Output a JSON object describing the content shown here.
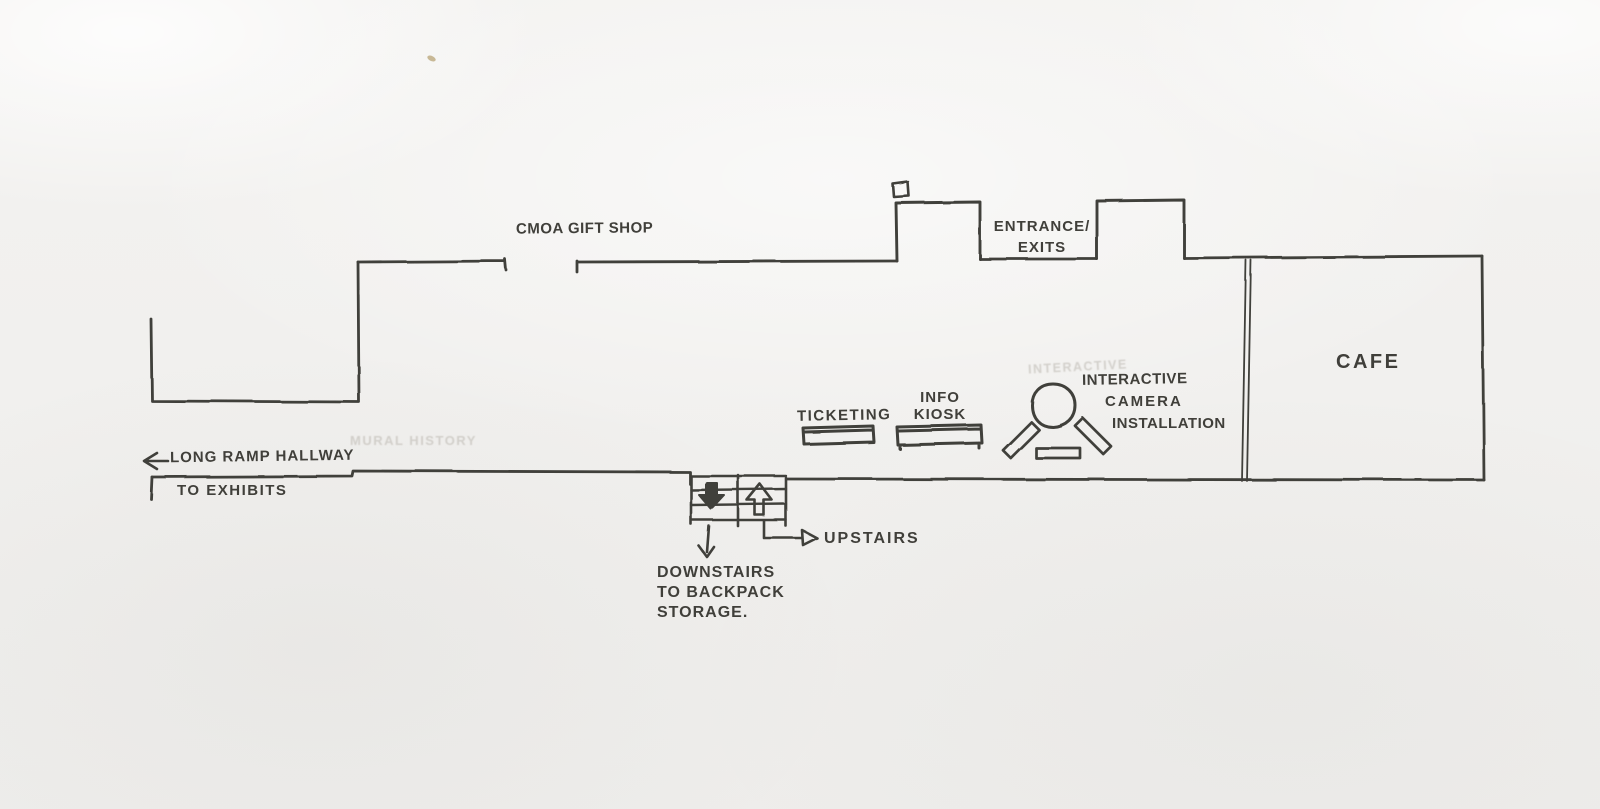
{
  "labels": {
    "gift_shop": "CMOA GIFT SHOP",
    "entrance_exits": "ENTRANCE/\nEXITS",
    "ticketing": "TICKETING",
    "info_kiosk": "INFO\nKIOSK",
    "camera_installation": [
      "INTERACTIVE",
      "CAMERA",
      "INSTALLATION"
    ],
    "cafe": "CAFE",
    "ramp_hallway": "LONG RAMP HALLWAY",
    "to_exhibits": "TO EXHIBITS",
    "upstairs": "UPSTAIRS",
    "downstairs": "DOWNSTAIRS\nTO BACKPACK\nSTORAGE.",
    "ghost_left": "MURAL HISTORY",
    "ghost_right": "INTERACTIVE"
  },
  "icons": {
    "ramp_arrow": "left-arrow",
    "stair_down_arrow": "down-arrow",
    "stair_up_arrow": "up-arrow",
    "downstairs_pointer": "down-arrow",
    "upstairs_pointer": "right-arrow",
    "security_camera_marker": "small-square"
  },
  "colors": {
    "ink": "#403f3a",
    "paper": "#f1f0ee",
    "ghost": "#c8c5bf"
  }
}
